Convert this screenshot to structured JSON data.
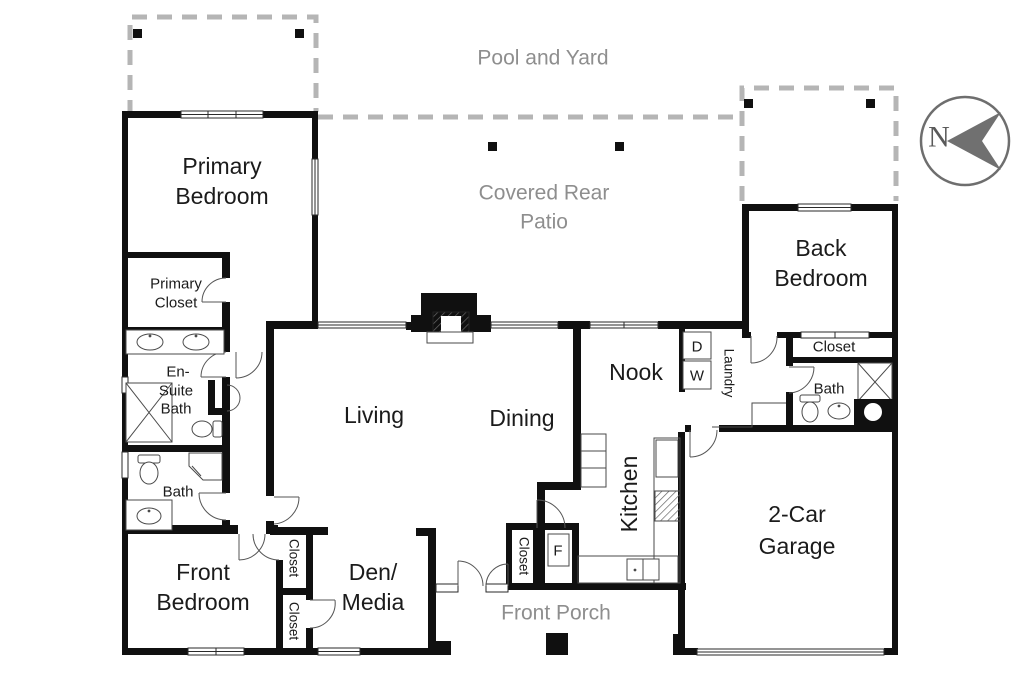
{
  "outdoor": {
    "pool_yard": "Pool and Yard",
    "patio_line1": "Covered Rear",
    "patio_line2": "Patio",
    "porch": "Front Porch"
  },
  "rooms": {
    "primary_bedroom": {
      "line1": "Primary",
      "line2": "Bedroom"
    },
    "primary_closet": {
      "line1": "Primary",
      "line2": "Closet"
    },
    "ensuite": {
      "line1": "En-",
      "line2": "Suite",
      "line3": "Bath"
    },
    "hall_bath": "Bath",
    "front_bedroom": {
      "line1": "Front",
      "line2": "Bedroom"
    },
    "closet_front": "Closet",
    "closet_den": "Closet",
    "den": {
      "line1": "Den/",
      "line2": "Media"
    },
    "living": "Living",
    "dining": "Dining",
    "nook": "Nook",
    "kitchen": "Kitchen",
    "laundry": "Laundry",
    "back_bedroom": {
      "line1": "Back",
      "line2": "Bedroom"
    },
    "closet_back": "Closet",
    "back_bath": "Bath",
    "garage": {
      "line1": "2-Car",
      "line2": "Garage"
    },
    "entry_closet": "Closet"
  },
  "appliances": {
    "dryer": "D",
    "washer": "W",
    "furnace": "F"
  },
  "compass": {
    "north": "N"
  },
  "colors": {
    "wall": "#101010",
    "outdoor_text": "#8e8e8e",
    "room_text": "#1b1b1b",
    "dashed_boundary": "#b5b5b5",
    "compass": "#707070",
    "background": "#ffffff"
  }
}
